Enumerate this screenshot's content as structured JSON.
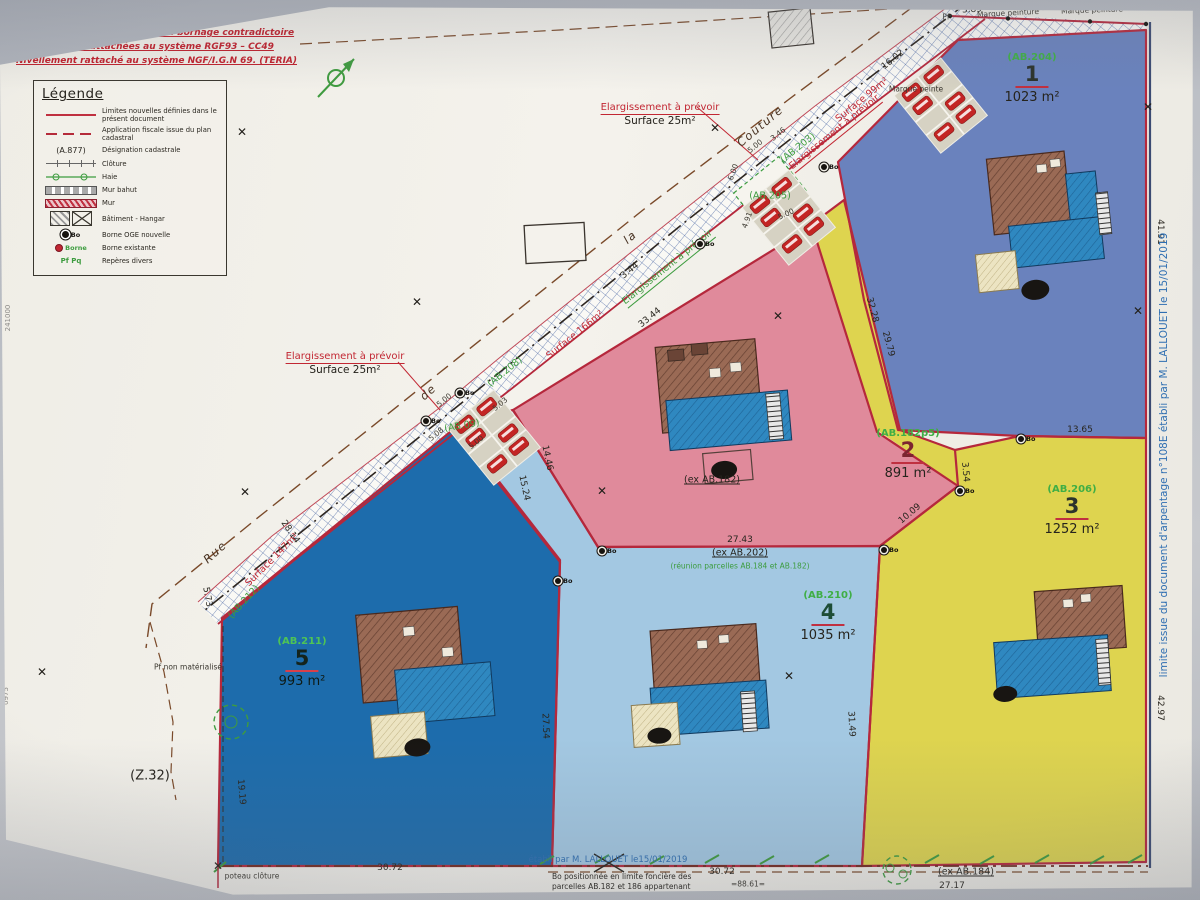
{
  "notices": {
    "line1": "Plan établi sans délimitation ni bornage contradictoire",
    "line2": "Coordonnées rattachées au système RGF93 – CC49",
    "line3": "Nivellement rattaché au système NGF/I.G.N 69. (TERIA)"
  },
  "legend": {
    "title": "Légende",
    "a877": "(A.877)",
    "borne_label": "Borne",
    "reperes_glyphs": "Pf  Pq",
    "items": [
      {
        "symbol": "new-limit-line",
        "label": "Limites nouvelles définies dans le présent document"
      },
      {
        "symbol": "fiscal-dash-line",
        "label": "Application fiscale issue du plan cadastral"
      },
      {
        "symbol": "cadastral-ref",
        "label": "Désignation cadastrale"
      },
      {
        "symbol": "fence",
        "label": "Clôture"
      },
      {
        "symbol": "hedge",
        "label": "Haie"
      },
      {
        "symbol": "low-wall",
        "label": "Mur bahut"
      },
      {
        "symbol": "wall",
        "label": "Mur"
      },
      {
        "symbol": "building-hangar",
        "label": "Bâtiment - Hangar"
      },
      {
        "symbol": "new-boundary-marker",
        "label": "Borne OGE nouvelle"
      },
      {
        "symbol": "existing-boundary-marker",
        "label": "Borne existante"
      },
      {
        "symbol": "misc-marks",
        "label": "Repères divers"
      }
    ]
  },
  "parcels": [
    {
      "num": "1",
      "ref": "(AB.204)",
      "area": "1023 m²"
    },
    {
      "num": "2",
      "ref": "(AB.182p5)",
      "area": "891 m²"
    },
    {
      "num": "3",
      "ref": "(AB.206)",
      "area": "1252 m²"
    },
    {
      "num": "4",
      "ref": "(AB.210)",
      "area": "1035 m²"
    },
    {
      "num": "5",
      "ref": "(AB.211)",
      "area": "993 m²"
    }
  ],
  "annotations": {
    "widen_title": "Elargissement à prévoir",
    "widen_surface": "Surface 25m²",
    "right_margin": "limite issue du document d'arpentage n°108E établi par M. LALLOUET le 15/01/2019",
    "bottom_blue": "établi par M. LALLOUET le15/01/2019",
    "bottom_note_left_1": "Bo positionnée en limite foncière des",
    "bottom_note_left_2": "parcelles AB.182 et 186 appartenant",
    "bottom_note_right": "Bo positionnée en limite foncière des"
  },
  "symbols": {
    "x_glyph": "✕",
    "bo_label": "Bo"
  },
  "colors": {
    "parcel1_blue": "#6a82bd",
    "parcel2_pink": "#e08a9b",
    "parcel3_yellow": "#ded44f",
    "parcel4_lightblue": "#a3c8e2",
    "parcel5_darkblue": "#1d6cac",
    "limit_red": "#b5283c",
    "label_green": "#3d9c3f",
    "note_blue": "#2f6fb2"
  },
  "map_texts": [
    {
      "t": "3.89",
      "x": 972,
      "y": 10,
      "r": -3
    },
    {
      "t": "9.83",
      "x": 1046,
      "y": 8,
      "r": -2
    },
    {
      "t": "3.96",
      "x": 1130,
      "y": 6,
      "r": -2
    },
    {
      "t": "Marque peinture",
      "x": 1008,
      "y": 13,
      "r": -3,
      "cls": "ms"
    },
    {
      "t": "Marque peinture",
      "x": 1092,
      "y": 10,
      "r": -2,
      "cls": "ms"
    },
    {
      "t": "Pf",
      "x": 946,
      "y": 17,
      "cls": "ms"
    },
    {
      "t": "Marque peinte",
      "x": 916,
      "y": 89,
      "cls": "ms"
    },
    {
      "t": "16.02",
      "x": 893,
      "y": 60,
      "r": -39
    },
    {
      "t": "41.91",
      "x": 1160,
      "y": 232,
      "r": 90
    },
    {
      "t": "32.28",
      "x": 872,
      "y": 310,
      "r": 75
    },
    {
      "t": "29.79",
      "x": 888,
      "y": 344,
      "r": 75
    },
    {
      "t": "13.65",
      "x": 1080,
      "y": 430
    },
    {
      "t": "42.97",
      "x": 1160,
      "y": 708,
      "r": 90
    },
    {
      "t": "27.17",
      "x": 952,
      "y": 886
    },
    {
      "t": "31.49",
      "x": 851,
      "y": 724,
      "r": 87
    },
    {
      "t": "27.43",
      "x": 740,
      "y": 540
    },
    {
      "t": "10.09",
      "x": 910,
      "y": 514,
      "r": -40
    },
    {
      "t": "3.54",
      "x": 965,
      "y": 472,
      "r": 85
    },
    {
      "t": "33.44",
      "x": 650,
      "y": 318,
      "r": -39
    },
    {
      "t": "3.44",
      "x": 630,
      "y": 271,
      "r": -39
    },
    {
      "t": "5.00",
      "x": 755,
      "y": 146,
      "r": -39,
      "cls": "ms"
    },
    {
      "t": "3.46",
      "x": 778,
      "y": 134,
      "r": -39,
      "cls": "ms"
    },
    {
      "t": "6.00",
      "x": 733,
      "y": 172,
      "r": -70,
      "cls": "ms"
    },
    {
      "t": "4.91",
      "x": 747,
      "y": 220,
      "r": -70,
      "cls": "ms"
    },
    {
      "t": "5.00",
      "x": 786,
      "y": 214,
      "r": -25,
      "cls": "ms"
    },
    {
      "t": "5.03",
      "x": 500,
      "y": 404,
      "r": -39,
      "cls": "ms"
    },
    {
      "t": "5.00",
      "x": 444,
      "y": 400,
      "r": -39,
      "cls": "ms"
    },
    {
      "t": "5.08",
      "x": 436,
      "y": 434,
      "r": -39,
      "cls": "ms"
    },
    {
      "t": "5.00",
      "x": 476,
      "y": 442,
      "r": -39,
      "cls": "ms"
    },
    {
      "t": "14.46",
      "x": 547,
      "y": 458,
      "r": 78
    },
    {
      "t": "15.24",
      "x": 524,
      "y": 488,
      "r": 78
    },
    {
      "t": "28.14",
      "x": 290,
      "y": 532,
      "r": 55
    },
    {
      "t": "5.73",
      "x": 207,
      "y": 597,
      "r": 80
    },
    {
      "t": "19.19",
      "x": 241,
      "y": 792,
      "r": 85
    },
    {
      "t": "27.54",
      "x": 545,
      "y": 726,
      "r": 88
    },
    {
      "t": "30.72",
      "x": 390,
      "y": 868
    },
    {
      "t": "30.72",
      "x": 722,
      "y": 872
    },
    {
      "t": "=88.61=",
      "x": 748,
      "y": 884,
      "cls": "ms"
    },
    {
      "t": "Pf non matérialisé",
      "x": 188,
      "y": 667,
      "cls": "ms"
    },
    {
      "t": "poteau clôture",
      "x": 252,
      "y": 876,
      "cls": "ms"
    },
    {
      "t": "(Z.32)",
      "x": 150,
      "y": 776,
      "cls": "big"
    },
    {
      "t": "Rue",
      "x": 215,
      "y": 552,
      "r": -42,
      "cls": "st"
    },
    {
      "t": "de",
      "x": 428,
      "y": 392,
      "r": -42,
      "cls": "st"
    },
    {
      "t": "la",
      "x": 630,
      "y": 237,
      "r": -40,
      "cls": "st"
    },
    {
      "t": "Couture",
      "x": 760,
      "y": 126,
      "r": -40,
      "cls": "st"
    },
    {
      "t": "Surface 99m²",
      "x": 862,
      "y": 100,
      "r": -39,
      "cls": "red"
    },
    {
      "t": "Elargissement à prévoir",
      "x": 835,
      "y": 133,
      "r": -39,
      "cls": "redU"
    },
    {
      "t": "(AB.203)",
      "x": 798,
      "y": 148,
      "r": -39,
      "cls": "grn"
    },
    {
      "t": "Surface 166m²",
      "x": 575,
      "y": 335,
      "r": -39,
      "cls": "red"
    },
    {
      "t": "(AB.208)",
      "x": 505,
      "y": 372,
      "r": -39,
      "cls": "grn"
    },
    {
      "t": "Elargissement à prévoir",
      "x": 668,
      "y": 268,
      "r": -39,
      "cls": "grnU"
    },
    {
      "t": "(AB.09)",
      "x": 462,
      "y": 426,
      "r": -10,
      "cls": "grn"
    },
    {
      "t": "(AB.205)",
      "x": 770,
      "y": 196,
      "cls": "grn"
    },
    {
      "t": "Surface 147m²",
      "x": 272,
      "y": 560,
      "r": -45,
      "cls": "red"
    },
    {
      "t": "(AB.212)",
      "x": 244,
      "y": 602,
      "r": -48,
      "cls": "grn"
    },
    {
      "t": "(ex AB.182)",
      "x": 712,
      "y": 480,
      "cls": "exU"
    },
    {
      "t": "(ex AB.202)",
      "x": 740,
      "y": 553,
      "cls": "exU"
    },
    {
      "t": "(réunion parcelles AB.184 et AB.182)",
      "x": 740,
      "y": 566,
      "cls": "grn-s"
    },
    {
      "t": "(ex AB.184)",
      "x": 966,
      "y": 872,
      "cls": "exU"
    },
    {
      "t": "241000",
      "x": 8,
      "y": 318,
      "r": -90,
      "cls": "ghost"
    },
    {
      "t": "0975",
      "x": 6,
      "y": 696,
      "r": -90,
      "cls": "ghost"
    }
  ],
  "bo_markers": [
    {
      "x": 824,
      "y": 166
    },
    {
      "x": 460,
      "y": 392
    },
    {
      "x": 426,
      "y": 420
    },
    {
      "x": 558,
      "y": 580
    },
    {
      "x": 602,
      "y": 550
    },
    {
      "x": 884,
      "y": 549
    },
    {
      "x": 960,
      "y": 490
    },
    {
      "x": 1021,
      "y": 438
    },
    {
      "x": 700,
      "y": 243
    }
  ],
  "x_marks": [
    {
      "x": 242,
      "y": 132
    },
    {
      "x": 417,
      "y": 302
    },
    {
      "x": 42,
      "y": 672
    },
    {
      "x": 245,
      "y": 492
    },
    {
      "x": 602,
      "y": 491
    },
    {
      "x": 778,
      "y": 316
    },
    {
      "x": 789,
      "y": 676
    },
    {
      "x": 1138,
      "y": 311
    },
    {
      "x": 1148,
      "y": 107
    },
    {
      "x": 715,
      "y": 128
    },
    {
      "x": 218,
      "y": 866
    }
  ]
}
